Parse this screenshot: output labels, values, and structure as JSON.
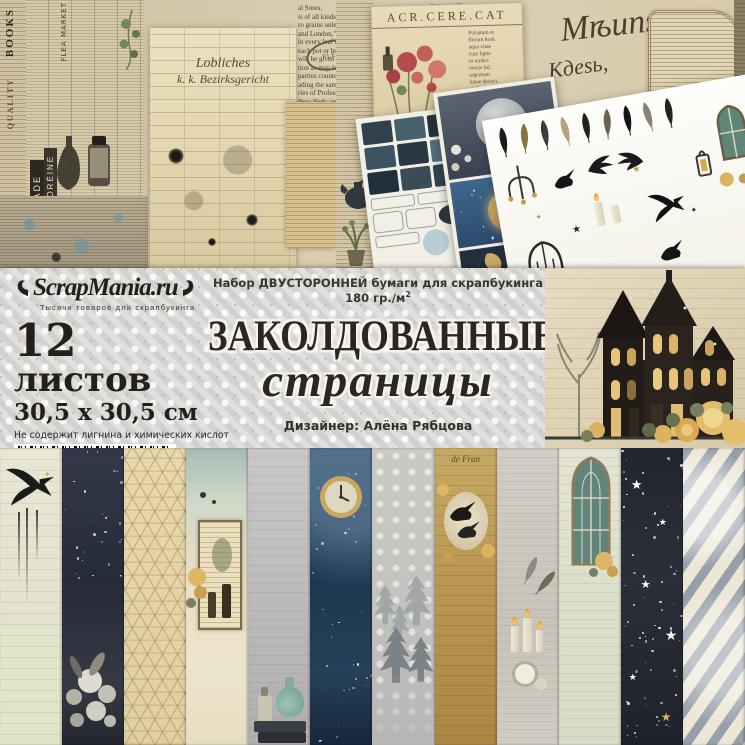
{
  "band": {
    "logo_text": "ScrapMania.ru",
    "tagline": "Тысячи товаров для скрапбукинга",
    "sheets_count_num": "12",
    "sheets_count_word": " листов",
    "sheet_size": "30,5 x 30,5 см",
    "acid_free": "Не содержит лигнина и химических кислот",
    "barcode": {
      "lead": "2",
      "group1": "009900",
      "group2": "753915"
    },
    "social_handle": "@scrapmania_tm",
    "article": "Арт. 254940",
    "description": "Набор ДВУСТОРОННЕЙ бумаги для скрапбукинга 180 гр./м",
    "description_sup": "2",
    "title_caps": "ЗАКОЛДОВАННЫЕ",
    "title_script": "страницы",
    "designer": "Дизайнер: Алёна Рябцова"
  },
  "collage": {
    "acr_title": "ACR.CERE.CAT",
    "script_line1": "Мѣиns",
    "script_line2": "Кдеѕь,",
    "ledger_line1": "Lobliches",
    "ledger_line2": "k. k. Bezirksgericht",
    "stamp_text": "PLEN",
    "vertical_labels": {
      "books": "BOOKS",
      "quality": "QUALITY",
      "nightshade": "NIGHTSHADE",
      "flea_market": "FLEA MARKET",
      "creme": "CRÈME FLORÉINE"
    },
    "news_left": [
      "al Sores,",
      "is of all kinds.",
      "ro grains unless",
      "and London,\"",
      "in every leaf of",
      "each pot or box;",
      "will be given to",
      "tion as may lead to",
      "parties counter-",
      "ading the same,",
      "ries of Professor",
      "New York, and by",
      "ers in Medicine",
      "and the civilized",
      "cents, and $1.00"
    ],
    "news_right": [
      "in pots at 25 cents,",
      "There is a considerable saving",
      "the larger sizes.",
      "N. B.—Directions for the guidance",
      "every disorder are offered to each"
    ]
  },
  "strips": [
    {
      "name": "raven-ink-paper"
    },
    {
      "name": "night-bouquet-paper"
    },
    {
      "name": "star-lattice-paper"
    },
    {
      "name": "botanical-frame-paper"
    },
    {
      "name": "potion-books-paper"
    },
    {
      "name": "celestial-clock-paper"
    },
    {
      "name": "misty-forest-paper"
    },
    {
      "name": "crow-nest-paper",
      "text": "de Fran"
    },
    {
      "name": "candles-feathers-paper"
    },
    {
      "name": "gothic-window-paper"
    },
    {
      "name": "starry-night-paper"
    },
    {
      "name": "diagonal-stripes-paper"
    }
  ],
  "palette": {
    "damask_gray": "#d8d6d3",
    "title_ink": "#2d2620",
    "aged_paper": "#d6c9ab",
    "gold": "#cfa85c",
    "night_navy": "#1f2633",
    "window_teal": "#5f8578"
  }
}
